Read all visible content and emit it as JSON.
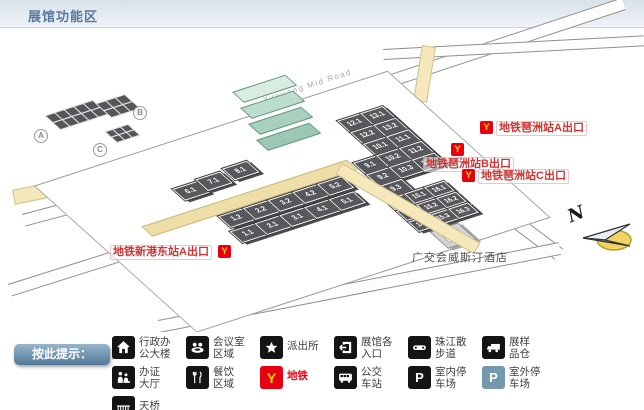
{
  "header": {
    "title": "展馆功能区"
  },
  "map": {
    "road_labels": {
      "top_road": "Yuejiang Mid Road",
      "east_road": "会展东路"
    },
    "building_markers": [
      {
        "label": "A"
      },
      {
        "label": "B"
      },
      {
        "label": "C"
      }
    ],
    "metro_exits": [
      {
        "id": "pazhou-a",
        "text": "地铁琶洲站A出口"
      },
      {
        "id": "pazhou-b",
        "text": "地铁琶洲站B出口"
      },
      {
        "id": "pazhou-c",
        "text": "地铁琶洲站C出口"
      },
      {
        "id": "xingangdong-a",
        "text": "地铁新港东站A出口"
      }
    ],
    "hotel_label": "广交会威斯汀酒店",
    "compass_label": "N",
    "halls": [
      {
        "label": "1.1",
        "area": "A",
        "x": 92,
        "y": 84
      },
      {
        "label": "2.1",
        "area": "A",
        "x": 118,
        "y": 84
      },
      {
        "label": "3.1",
        "area": "A",
        "x": 144,
        "y": 84
      },
      {
        "label": "4.1",
        "area": "A",
        "x": 170,
        "y": 84
      },
      {
        "label": "5.1",
        "area": "A",
        "x": 196,
        "y": 84
      },
      {
        "label": "1.2",
        "area": "A",
        "x": 96,
        "y": 66
      },
      {
        "label": "2.2",
        "area": "A",
        "x": 122,
        "y": 66
      },
      {
        "label": "3.2",
        "area": "A",
        "x": 148,
        "y": 66
      },
      {
        "label": "4.2",
        "area": "A",
        "x": 174,
        "y": 66
      },
      {
        "label": "5.2",
        "area": "A",
        "x": 200,
        "y": 66
      },
      {
        "label": "6.1",
        "area": "A",
        "x": 84,
        "y": 26
      },
      {
        "label": "7.1",
        "area": "A",
        "x": 110,
        "y": 24
      },
      {
        "label": "8.1",
        "area": "A",
        "x": 140,
        "y": 22
      },
      {
        "label": "12.1",
        "area": "B",
        "x": 270,
        "y": 12
      },
      {
        "label": "13.1",
        "area": "B",
        "x": 294,
        "y": 12
      },
      {
        "label": "12.2",
        "area": "B",
        "x": 270,
        "y": 27
      },
      {
        "label": "13.2",
        "area": "B",
        "x": 294,
        "y": 27
      },
      {
        "label": "10.1",
        "area": "B",
        "x": 270,
        "y": 42
      },
      {
        "label": "11.1",
        "area": "B",
        "x": 294,
        "y": 42
      },
      {
        "label": "9.1",
        "area": "B",
        "x": 246,
        "y": 57
      },
      {
        "label": "10.2",
        "area": "B",
        "x": 270,
        "y": 57
      },
      {
        "label": "11.2",
        "area": "B",
        "x": 294,
        "y": 57
      },
      {
        "label": "9.2",
        "area": "B",
        "x": 246,
        "y": 72
      },
      {
        "label": "10.3",
        "area": "B",
        "x": 270,
        "y": 72
      },
      {
        "label": "11.3",
        "area": "B",
        "x": 294,
        "y": 72
      },
      {
        "label": "9.3",
        "area": "B",
        "x": 246,
        "y": 87
      },
      {
        "label": "14.1",
        "area": "C",
        "x": 238,
        "y": 102
      },
      {
        "label": "15.1",
        "area": "C",
        "x": 259,
        "y": 102
      },
      {
        "label": "16.1",
        "area": "C",
        "x": 280,
        "y": 102
      },
      {
        "label": "14.2",
        "area": "C",
        "x": 238,
        "y": 116
      },
      {
        "label": "15.2",
        "area": "C",
        "x": 259,
        "y": 116
      },
      {
        "label": "16.2",
        "area": "C",
        "x": 280,
        "y": 116
      },
      {
        "label": "14.3",
        "area": "C",
        "x": 238,
        "y": 130
      },
      {
        "label": "15.3",
        "area": "C",
        "x": 259,
        "y": 130
      },
      {
        "label": "16.3",
        "area": "C",
        "x": 280,
        "y": 130
      }
    ]
  },
  "icons": {
    "metro_glyph": "Y",
    "parking_glyph": "P"
  },
  "legend": {
    "prompt": "按此提示：",
    "items": [
      {
        "icon": "admin-building-icon",
        "line1": "行政办",
        "line2": "公大楼"
      },
      {
        "icon": "meeting-room-icon",
        "line1": "会议室",
        "line2": "区域"
      },
      {
        "icon": "police-station-icon",
        "line1": "派出所",
        "line2": ""
      },
      {
        "icon": "hall-entrance-icon",
        "line1": "展馆各",
        "line2": "入口"
      },
      {
        "icon": "riverside-walkway-icon",
        "line1": "珠江散",
        "line2": "步道"
      },
      {
        "icon": "sample-warehouse-icon",
        "line1": "展样",
        "line2": "品仓"
      },
      {
        "icon": "certificate-hall-icon",
        "line1": "办证",
        "line2": "大厅"
      },
      {
        "icon": "dining-area-icon",
        "line1": "餐饮",
        "line2": "区域"
      },
      {
        "icon": "metro-icon",
        "line1": "地铁",
        "line2": ""
      },
      {
        "icon": "bus-station-icon",
        "line1": "公交",
        "line2": "车站"
      },
      {
        "icon": "indoor-parking-icon",
        "line1": "室内停",
        "line2": "车场"
      },
      {
        "icon": "outdoor-parking-icon",
        "line1": "室外停",
        "line2": "车场"
      },
      {
        "icon": "footbridge-icon",
        "line1": "天桥",
        "line2": ""
      }
    ]
  },
  "colors": {
    "metro_red": "#e60012",
    "metro_yellow": "#ffd200",
    "walkway_yellow": "#eedfa8",
    "hall_dark": "#57575c",
    "legend_badge_blue": "#527899",
    "outdoor_parking_blue": "#7499ad",
    "exit_label_red": "#cf3434",
    "header_text_blue": "#56799e"
  }
}
